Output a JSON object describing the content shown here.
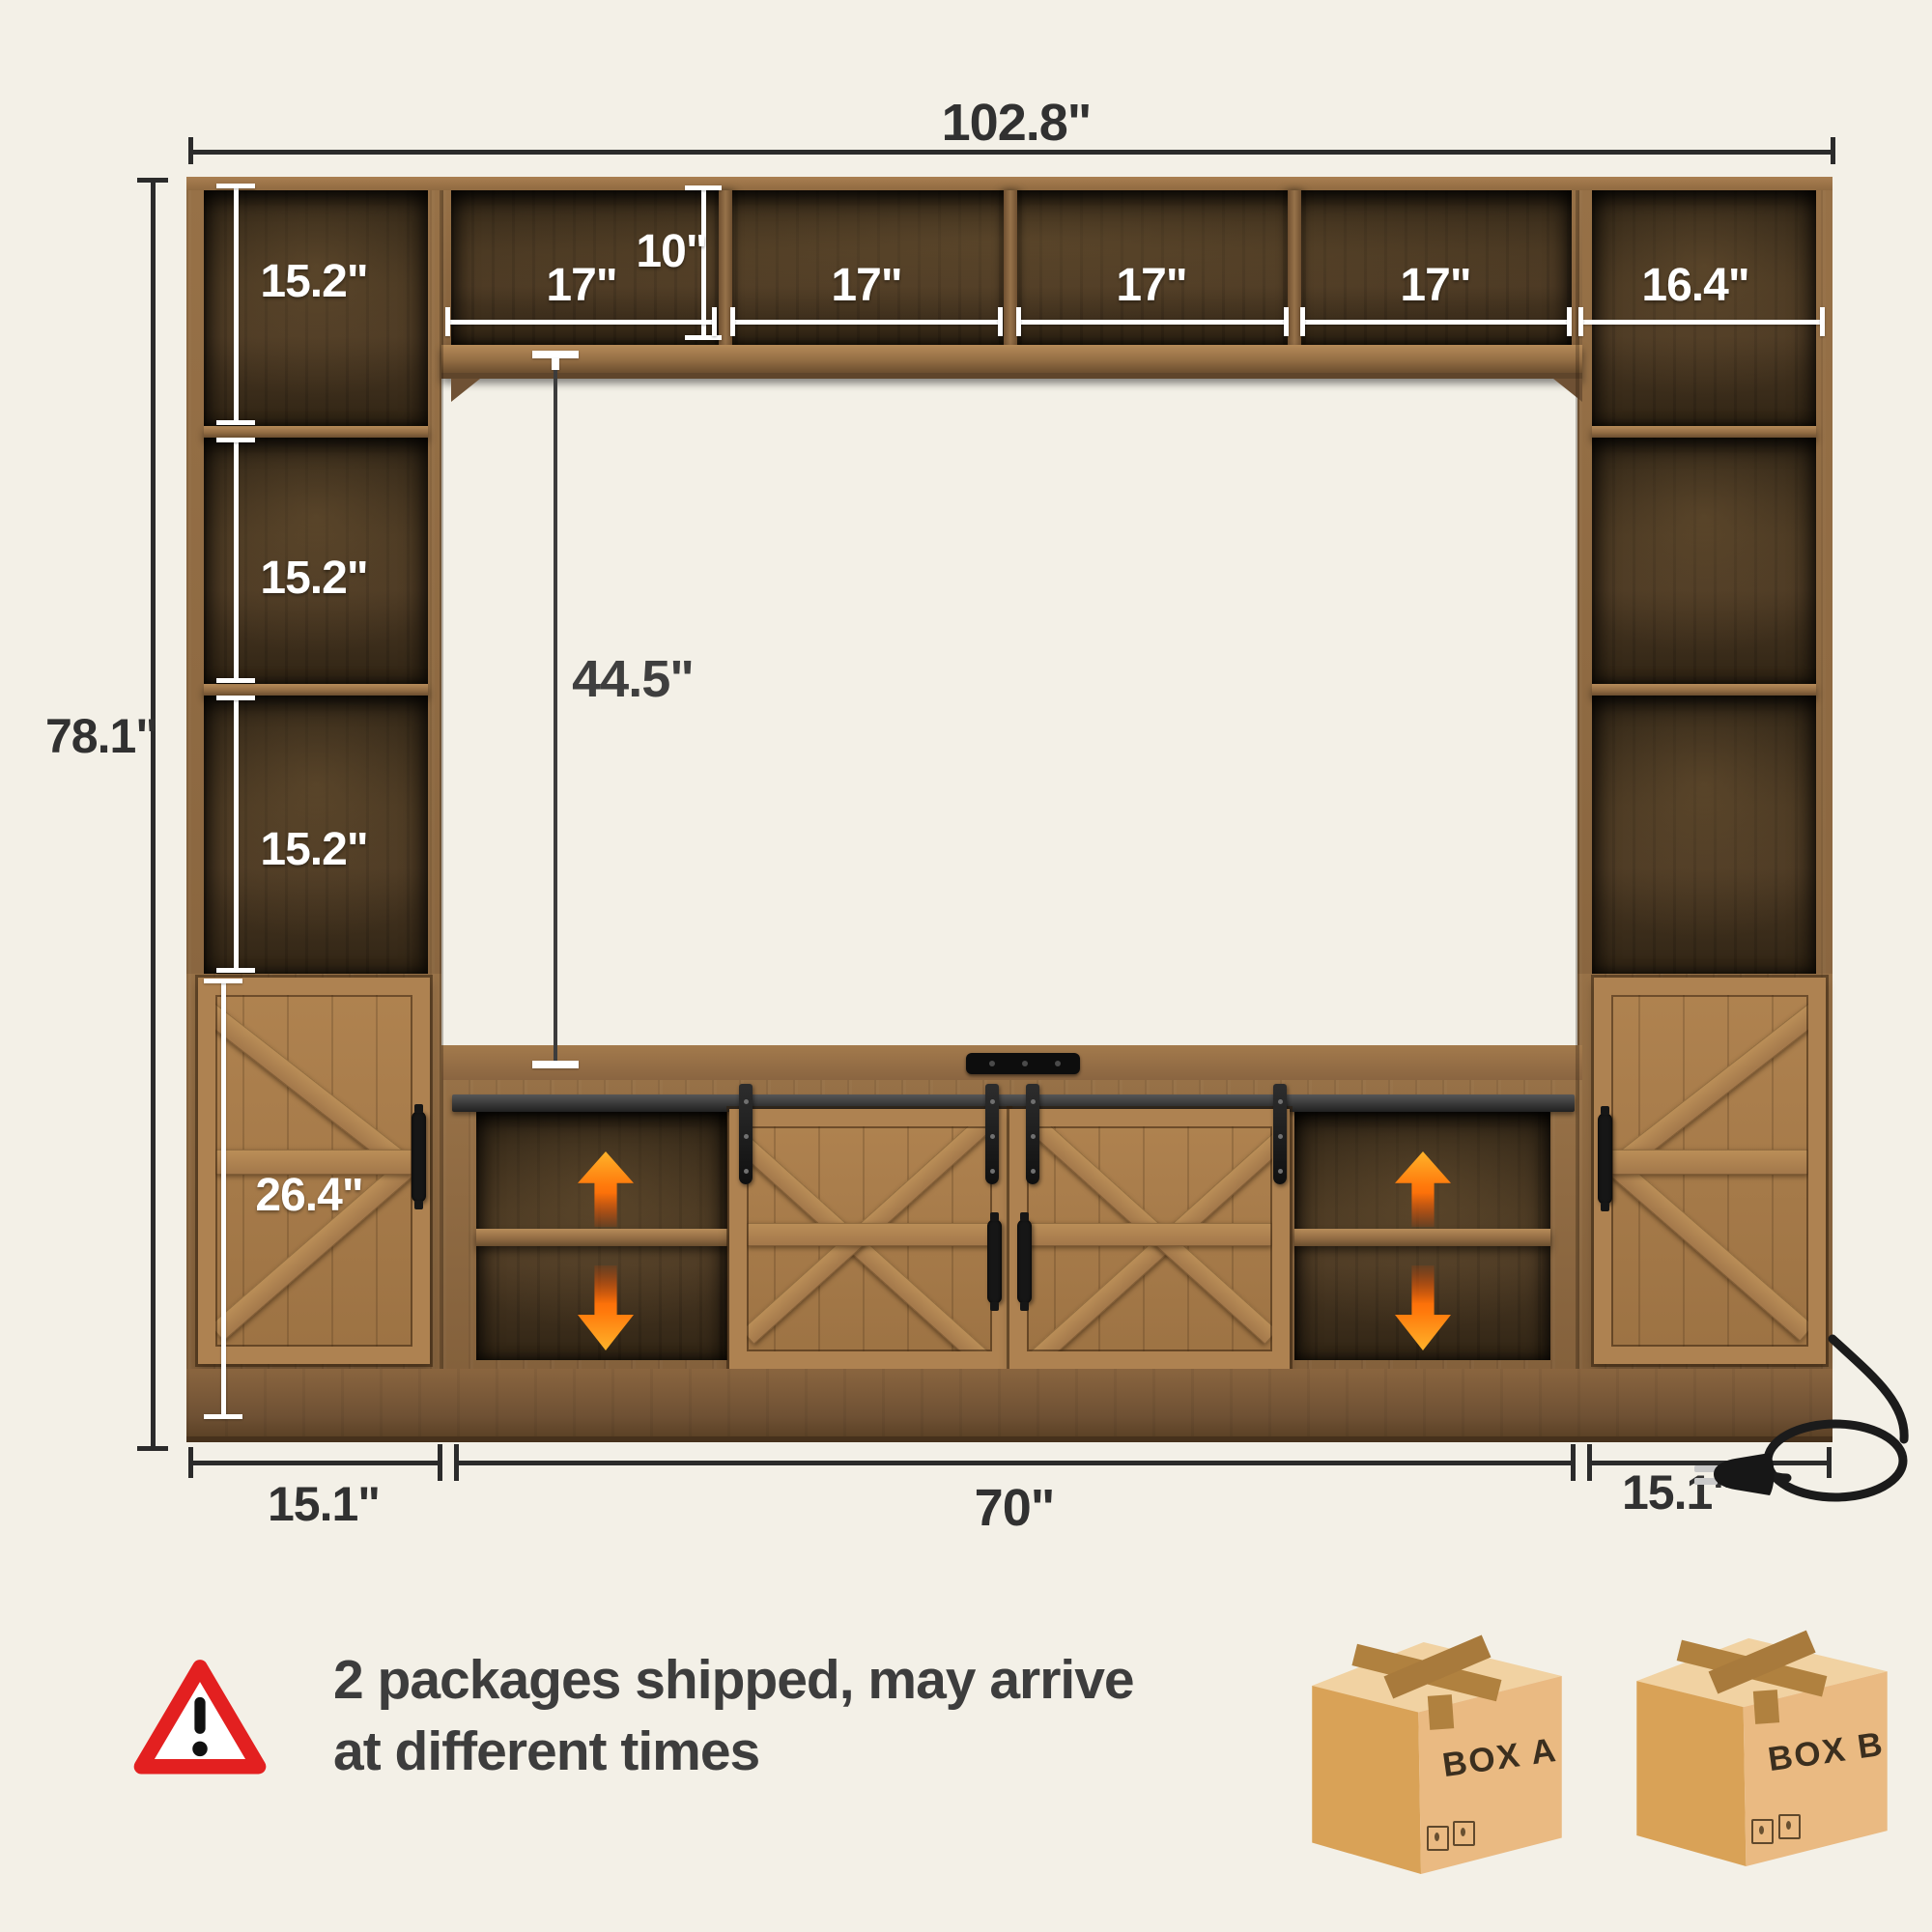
{
  "colors": {
    "background": "#f3f0e7",
    "accent_orange": "#f96a00",
    "warning_red": "#e32020",
    "dimension_dark": "#2e2e2e",
    "dimension_white": "#ffffff",
    "wood_frame": "#8a6540",
    "wood_door": "#a97c4a",
    "wood_interior": "#3a2d1d",
    "notice_text": "#3d3d3d",
    "box_cardboard": "#eaba82"
  },
  "dimension_labels": {
    "overall_width": "102.8\"",
    "overall_height": "78.1\"",
    "left_cubbies": [
      "15.2\"",
      "15.2\"",
      "15.2\""
    ],
    "hutch_height": "10\"",
    "hutch_cubbies": [
      "17\"",
      "17\"",
      "17\"",
      "17\""
    ],
    "right_top_cubby": "16.4\"",
    "tv_opening_height": "44.5\"",
    "side_cabinet_height": "26.4\"",
    "bottom_left": "15.1\"",
    "bottom_center": "70\"",
    "bottom_right": "15.1\""
  },
  "notice": {
    "line1": "2 packages shipped, may arrive",
    "line2": "at different times"
  },
  "packages": [
    {
      "label": "BOX A"
    },
    {
      "label": "BOX B"
    }
  ]
}
